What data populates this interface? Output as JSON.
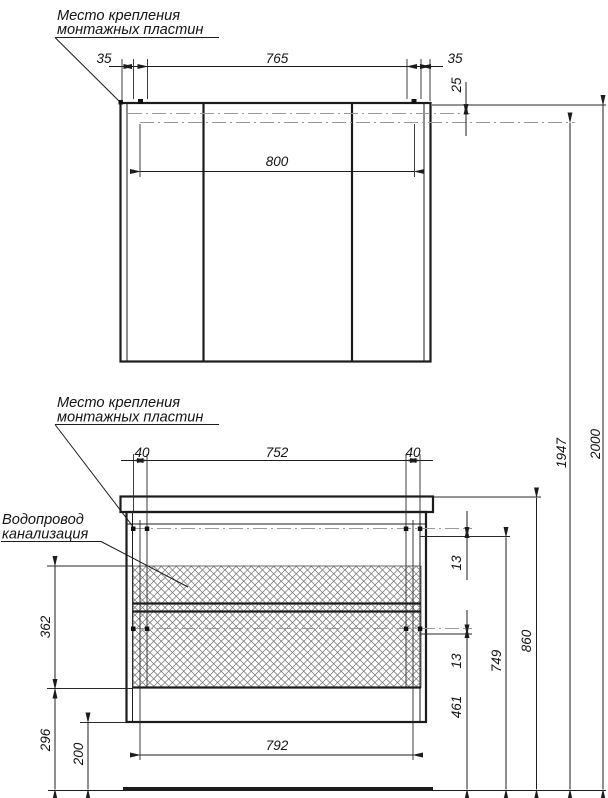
{
  "drawing": {
    "kind": "furniture installation drawing",
    "labels": {
      "mirror_mounting": {
        "line1": "Место крепления",
        "line2": "монтажных пластин"
      },
      "base_mounting": {
        "line1": "Место крепления",
        "line2": "монтажных пластин"
      },
      "plumbing": {
        "line1": "Водопровод",
        "line2": "канализация"
      }
    },
    "dims": {
      "mirror": {
        "left_offset": "35",
        "plate_span": "765",
        "right_offset": "35",
        "plate_drop": "25",
        "width": "800"
      },
      "base": {
        "left_offset": "40",
        "plate_span": "752",
        "right_offset": "40",
        "gap_upper": "13",
        "gap_lower": "13",
        "bottom_width": "792"
      },
      "vertical": {
        "total": "2000",
        "mirror_plates": "1947",
        "countertop": "860",
        "plates_upper": "749",
        "plates_lower": "461",
        "plumbing_zone": "362",
        "below_zone": "296",
        "floor_clearance": "200"
      }
    },
    "colors": {
      "line": "#1c1c1c",
      "centerline": "#9a9a9a",
      "hatch": "#6f6f6f",
      "background": "#ffffff"
    }
  }
}
